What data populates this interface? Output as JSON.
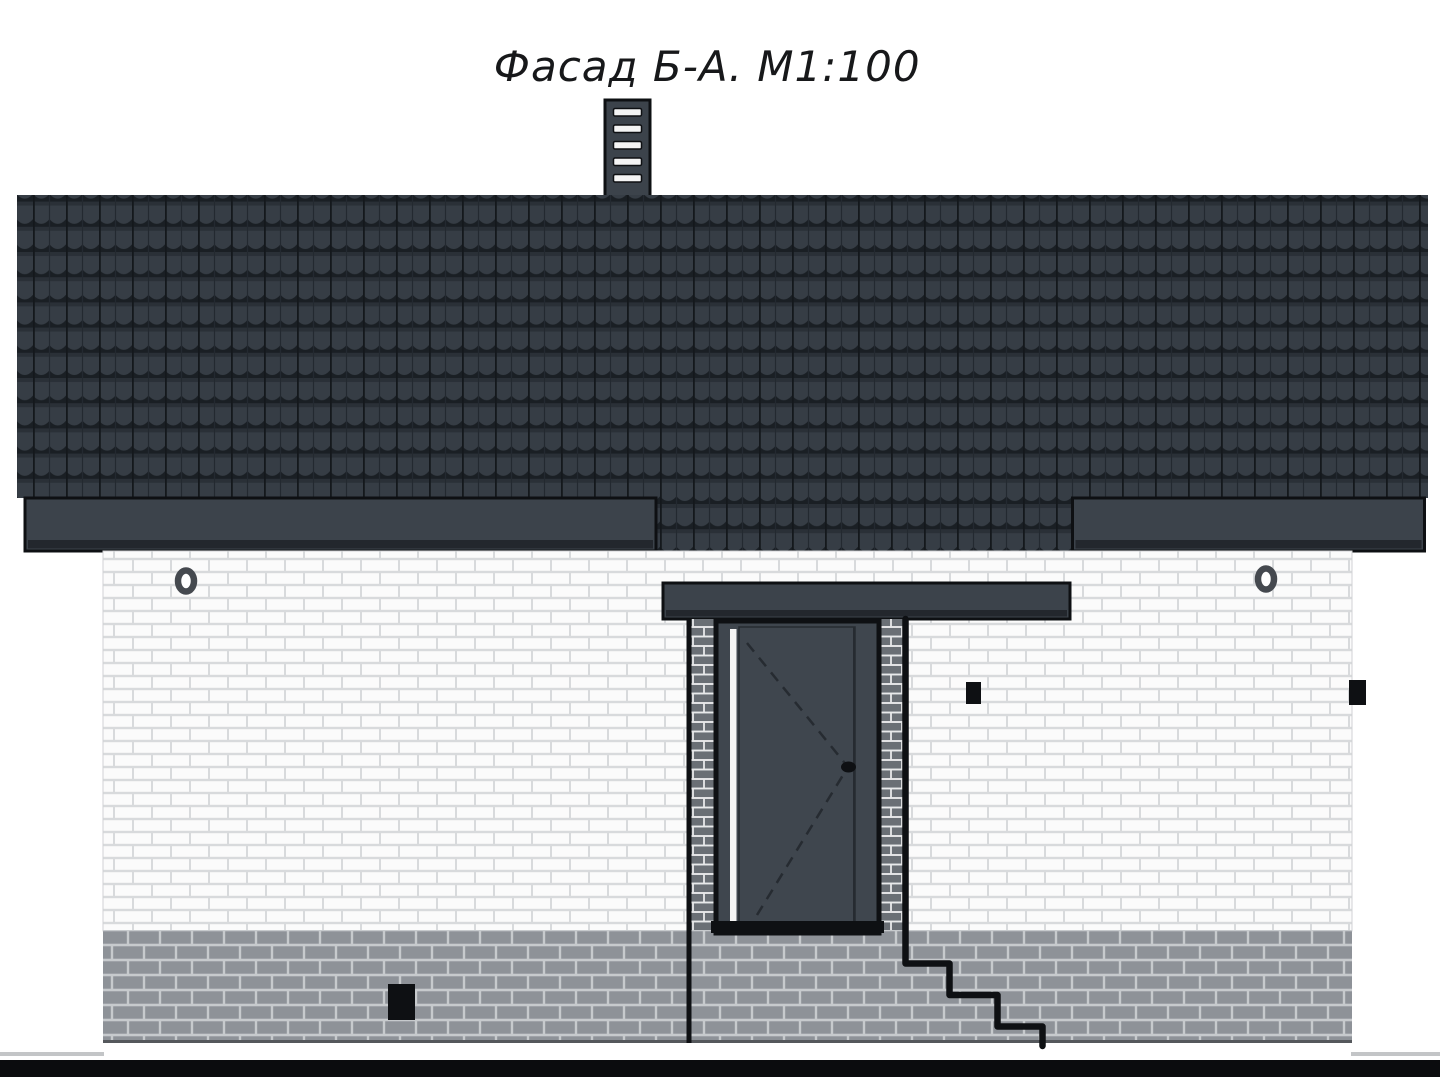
{
  "drawing": {
    "title": "Фасад Б-А. М1:100",
    "facade_name": "Фасад Б-А.",
    "scale": "М1:100"
  },
  "colors": {
    "background": "#ffffff",
    "title_text": "#17181a",
    "roof_tile": "#363d45",
    "roof_row_shadow": "#2a3037",
    "roof_shadow": "#1a1f24",
    "roof_rib": "#14181c",
    "roof_rib2": "#232930",
    "fascia": "#3c434b",
    "fascia_dark": "#23272d",
    "outline": "#0e1013",
    "wall_brick": "#fbfbfb",
    "wall_mortar": "#d8dadc",
    "pillar_brick": "#6a6f75",
    "pillar_mortar": "#e8e9ea",
    "plinth_brick": "#8e9298",
    "plinth_mortar": "#c7cacd",
    "plinth_base": "#55585c",
    "door": "#3f464e",
    "door_trim": "#f4f4f4",
    "door_line": "#262b31",
    "ring_vent": "#45494f",
    "ground": "#0b0c0e",
    "ground_line": "#c3c5c7"
  }
}
